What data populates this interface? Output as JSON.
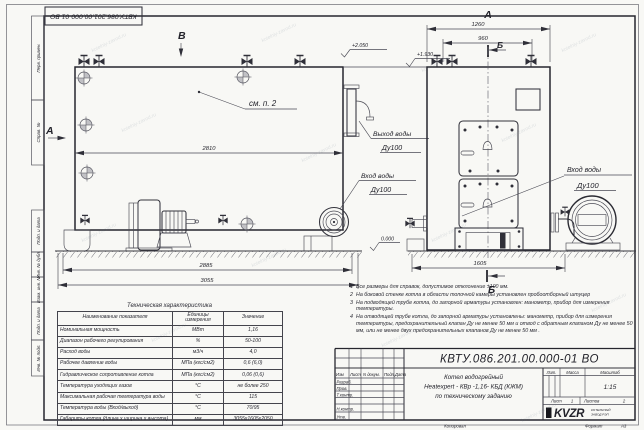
{
  "sheet": {
    "designation": "КВТУ.086.201.00.000-01 ВО",
    "format_label": "Формат",
    "format_value": "А3",
    "copied_label": "Копировал",
    "watermark": "kotelniy-zavod.ru"
  },
  "margin": {
    "items": [
      "Перв. примен.",
      "Справ. №",
      "Подп. и дата",
      "Инв. № дубл.",
      "Взам. инв. №",
      "Подп. и дата",
      "Инв. № подл."
    ]
  },
  "side_view": {
    "label_a": "А",
    "label_b": "В",
    "see_note": "см. п. 2",
    "dim_2810": "2810",
    "dim_2885": "2885",
    "dim_3055": "3055",
    "level_top": "+2.050",
    "level_mid": "+1.930",
    "level_zero": "0.000",
    "outlet_line1": "Выход воды",
    "outlet_line2": "Ду100",
    "inlet_line1": "Вход воды",
    "inlet_line2": "Ду100"
  },
  "front_view": {
    "label_a": "А",
    "label_b_top": "Б",
    "label_b_bottom": "Б",
    "dim_1260": "1260",
    "dim_960": "960",
    "dim_1605": "1605",
    "inlet_line1": "Вход воды",
    "inlet_line2": "Ду100"
  },
  "tech_table": {
    "title": "Техническая характеристика",
    "headers": [
      "Наименование показателя",
      "Единицы измерения",
      "Значение"
    ],
    "rows": [
      [
        "Номинальная мощность",
        "МВт",
        "1,16"
      ],
      [
        "Диапазон рабочего регулирования",
        "%",
        "50-100"
      ],
      [
        "Расход воды",
        "м3/ч",
        "4,0"
      ],
      [
        "Рабочее давление воды",
        "МПа (кгс/см2)",
        "0,6 (6,0)"
      ],
      [
        "Гидравлическое сопротивление котла",
        "МПа (кгс/см2)",
        "0,06 (0,6)"
      ],
      [
        "Температура уходящих газов",
        "°С",
        "не более 250"
      ],
      [
        "Максимальная рабочая температура воды",
        "°С",
        "115"
      ],
      [
        "Температура воды (Вход/выход)",
        "°С",
        "70/95"
      ],
      [
        "Габариты котла (длина х ширина х высота)",
        "мм",
        "3055х1605х2050"
      ]
    ]
  },
  "notes": {
    "items": [
      {
        "num": "1",
        "text": "Все размеры для справок, допустимое отклонение ±100 мм."
      },
      {
        "num": "2",
        "text": "На боковой стенке котла в области топочной камеры установлен пробоотборный штуцер"
      },
      {
        "num": "3",
        "text": "На подводящей трубе котла, до запорной арматуры установлен: манометр, прибор для измерения температуры."
      },
      {
        "num": "4",
        "text": "На отводящей трубе котла, до запорной арматуры установлены: манометр, прибор для измерения температуры, предохранительный клапан Ду не менее 50 мм и отвод с обратным клапаном Ду не менее 50 мм, или не менее двух предохранительных клапанов Ду не менее 50 мм ."
      }
    ]
  },
  "title_block": {
    "designation": "КВТУ.086.201.00.000-01 ВО",
    "col_izm": "Изм",
    "col_list": "Лист",
    "col_docnum": "N докум.",
    "col_podp": "Подп.",
    "col_data": "Дата",
    "row_razrab": "Разраб.",
    "row_prov": "Пров.",
    "row_tkontr": "Т.контр.",
    "row_nkontr": "Н.контр.",
    "row_utv": "Утв.",
    "name_line1": "Котел водогрейный",
    "name_line2": "Heatexpert - КВр -1,16- КБД (КЖМ)",
    "name_line3": "по техническому заданию",
    "lit_label": "Лит.",
    "mass_label": "Масса",
    "scale_label": "Масштаб",
    "scale_value": "1:15",
    "sheet_label": "Лист",
    "sheet_value": "1",
    "sheets_label": "Листов",
    "sheets_value": "2",
    "logo": "KVZR",
    "logo_sub1": "КОТЕЛЬНЫЙ",
    "logo_sub2": "ЗАВОД РЭП"
  }
}
